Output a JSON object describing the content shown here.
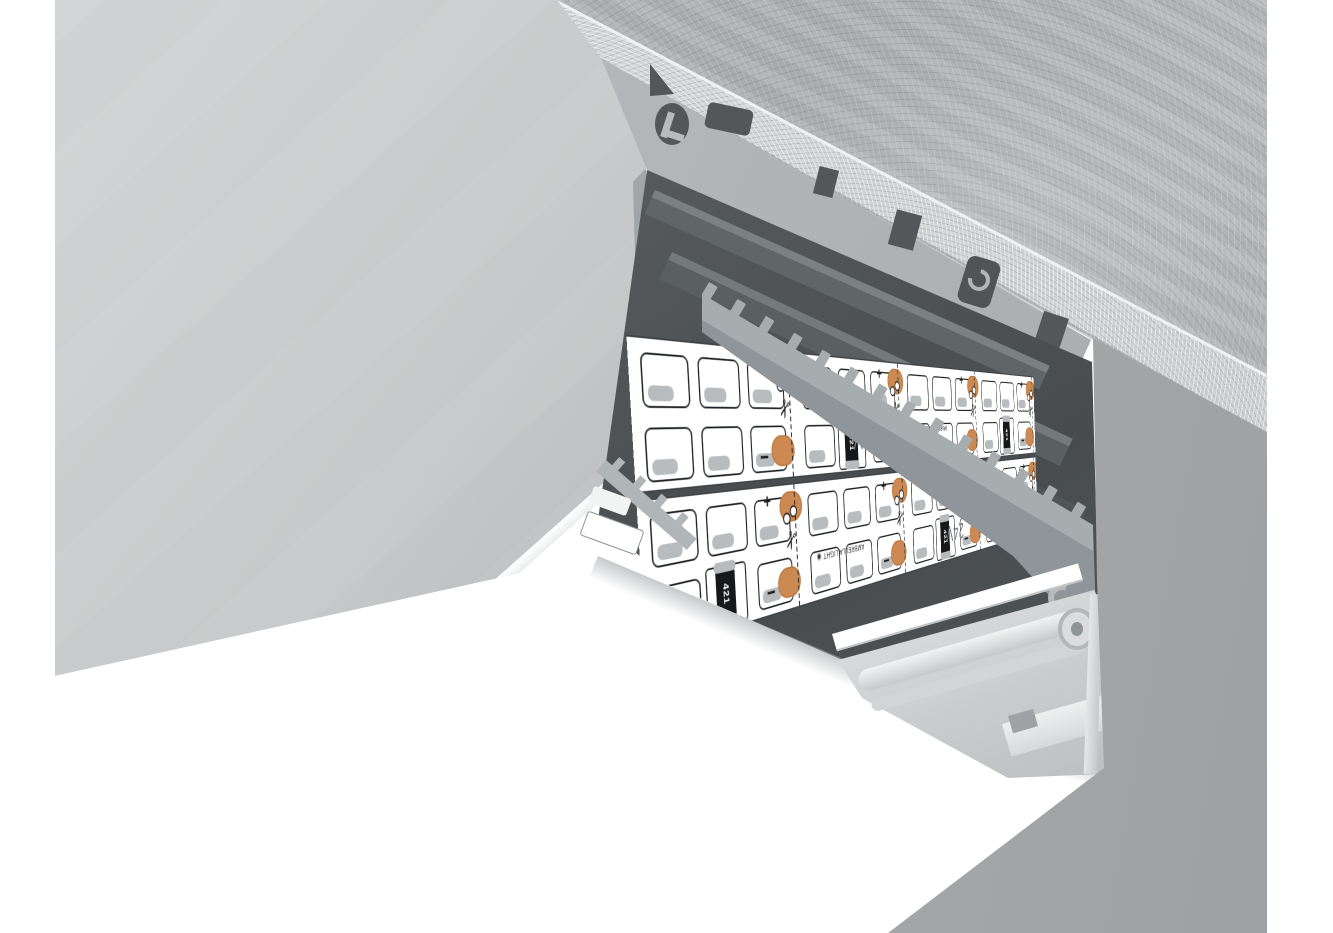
{
  "scene": {
    "type": "3d-product-render",
    "description": "Recessed aluminium LED profile mounted in a concrete ceiling, cross-sectioned, with two 24V LED strips inside the channel and a glowing white diffuser",
    "background_color": "#ffffff"
  },
  "materials": {
    "concrete_surface": "#b1b4b6",
    "concrete_cut_edge": "#cfd2d3",
    "recess_wall": "#b5b8ba",
    "aluminium_face": "#b3b7b9",
    "channel_interior": "#54585a",
    "fin_wall": "#a7acae",
    "background_wall": "#a3a5a7",
    "diffuser": "#ffffff",
    "pcb_white": "#ffffff",
    "solder_pad_copper": "#cc8a52",
    "resistor_body": "#17181a",
    "silkscreen_ink": "#1f1f1f"
  },
  "led_strip": {
    "voltage_label": "24V",
    "brand_label": "AMBRELLA LIGHT",
    "brand_logo_glyph": "◉",
    "resistor_code": "421",
    "plus_label": "+",
    "minus_label": "−",
    "scissors_glyph": "✂",
    "strip_count": 2,
    "segments_per_strip": 4,
    "led_columns_per_segment": 3,
    "led_rows_per_strip": 2
  }
}
